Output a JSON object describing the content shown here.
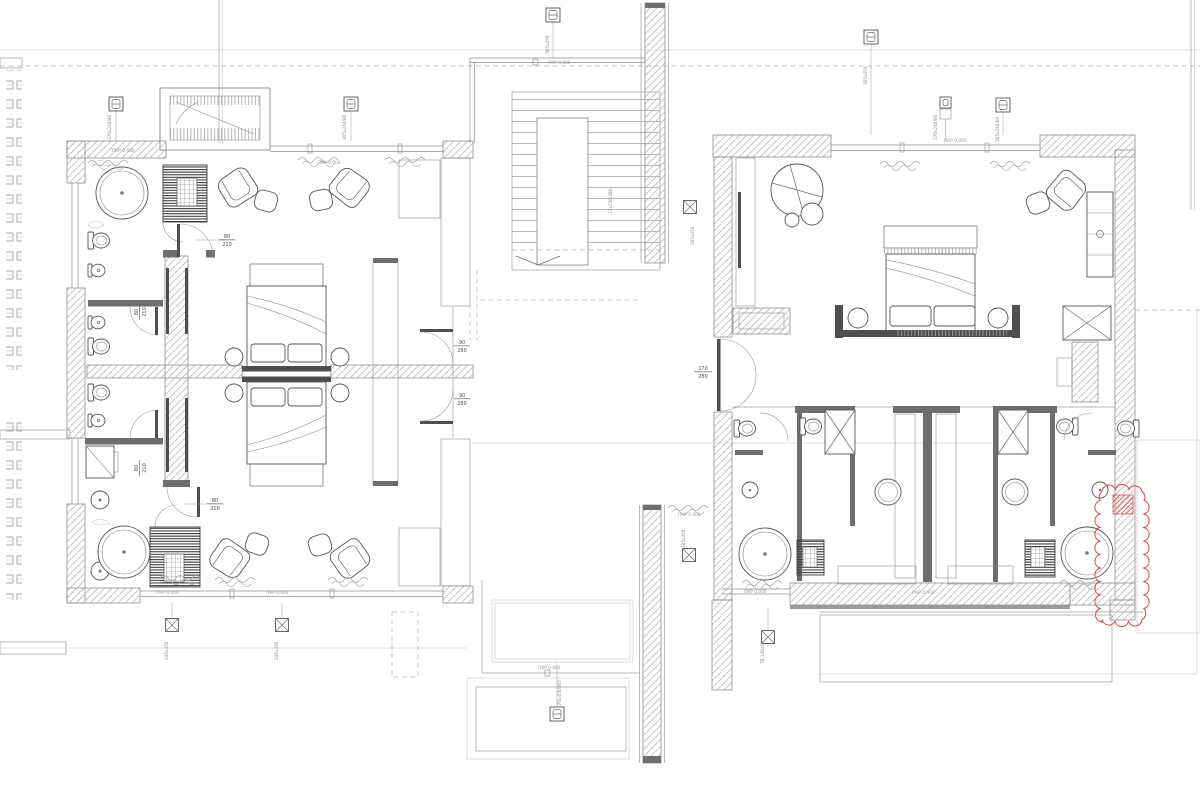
{
  "drawing": {
    "type": "architectural-floor-plan",
    "level_mark": "ПКР 0.000",
    "stair_note": "21x156/300",
    "doors": {
      "d80": {
        "w": "80",
        "h": "210"
      },
      "d90": {
        "w": "90",
        "h": "280"
      },
      "d170": {
        "w": "170",
        "h": "280"
      }
    },
    "window_marks": {
      "wm_left_a": "170x240/80",
      "wm_left_b": "305x240/80",
      "wm_top": "305x450",
      "wm_right_top": "305x450",
      "wm_right_a": "170x240/80",
      "wm_right_b": "305x240/80",
      "wm_core": "305x450",
      "wm_core_low": "305x450",
      "wm_south_a": "240x450",
      "wm_south_b": "240x450",
      "wm_terrace": "170x450/305",
      "wm_tv": "ТВ 140x60"
    },
    "colors": {
      "paper": "#ffffff",
      "ink": "#4a4a4a",
      "light_line": "#9a9a9a",
      "hatch": "#bdbdbd",
      "dark_fill": "#3c3c3c",
      "revision_red": "#d8453e"
    }
  }
}
